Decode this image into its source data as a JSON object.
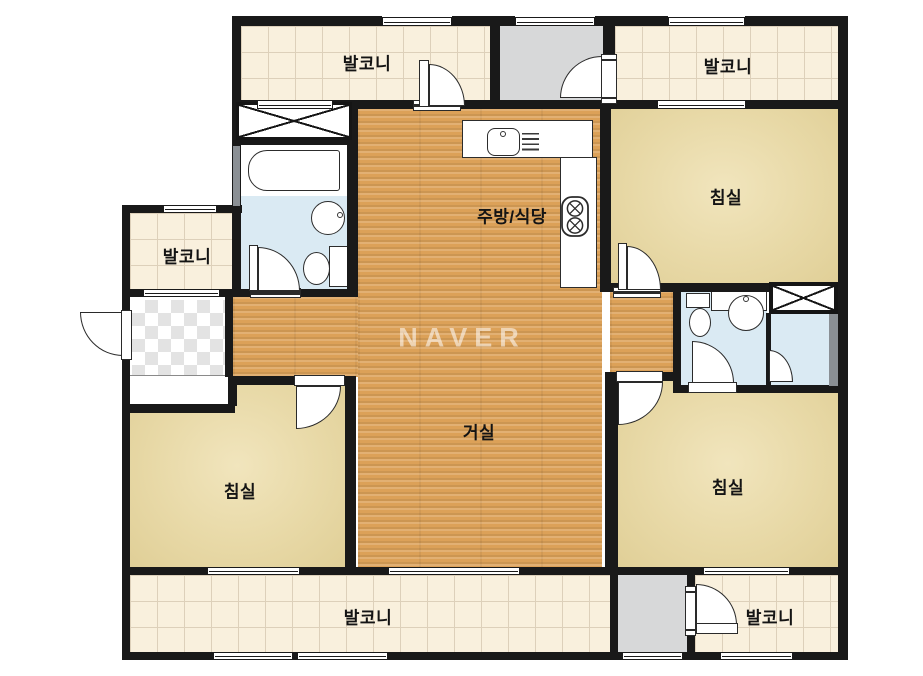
{
  "floorplan": {
    "watermark": "NAVER",
    "labels": {
      "balcony": "발코니",
      "bedroom": "침실",
      "kitchen_dining": "주방/식당",
      "living_room": "거실"
    },
    "colors": {
      "wall": "#191919",
      "wood_floor": "#dca158",
      "bedroom_floor": "#e8d9a7",
      "balcony_floor": "#f9f0dd",
      "bathroom_floor": "#daeaf3",
      "utility_room": "#d7d8d9",
      "fixture": "#ffffff"
    }
  }
}
